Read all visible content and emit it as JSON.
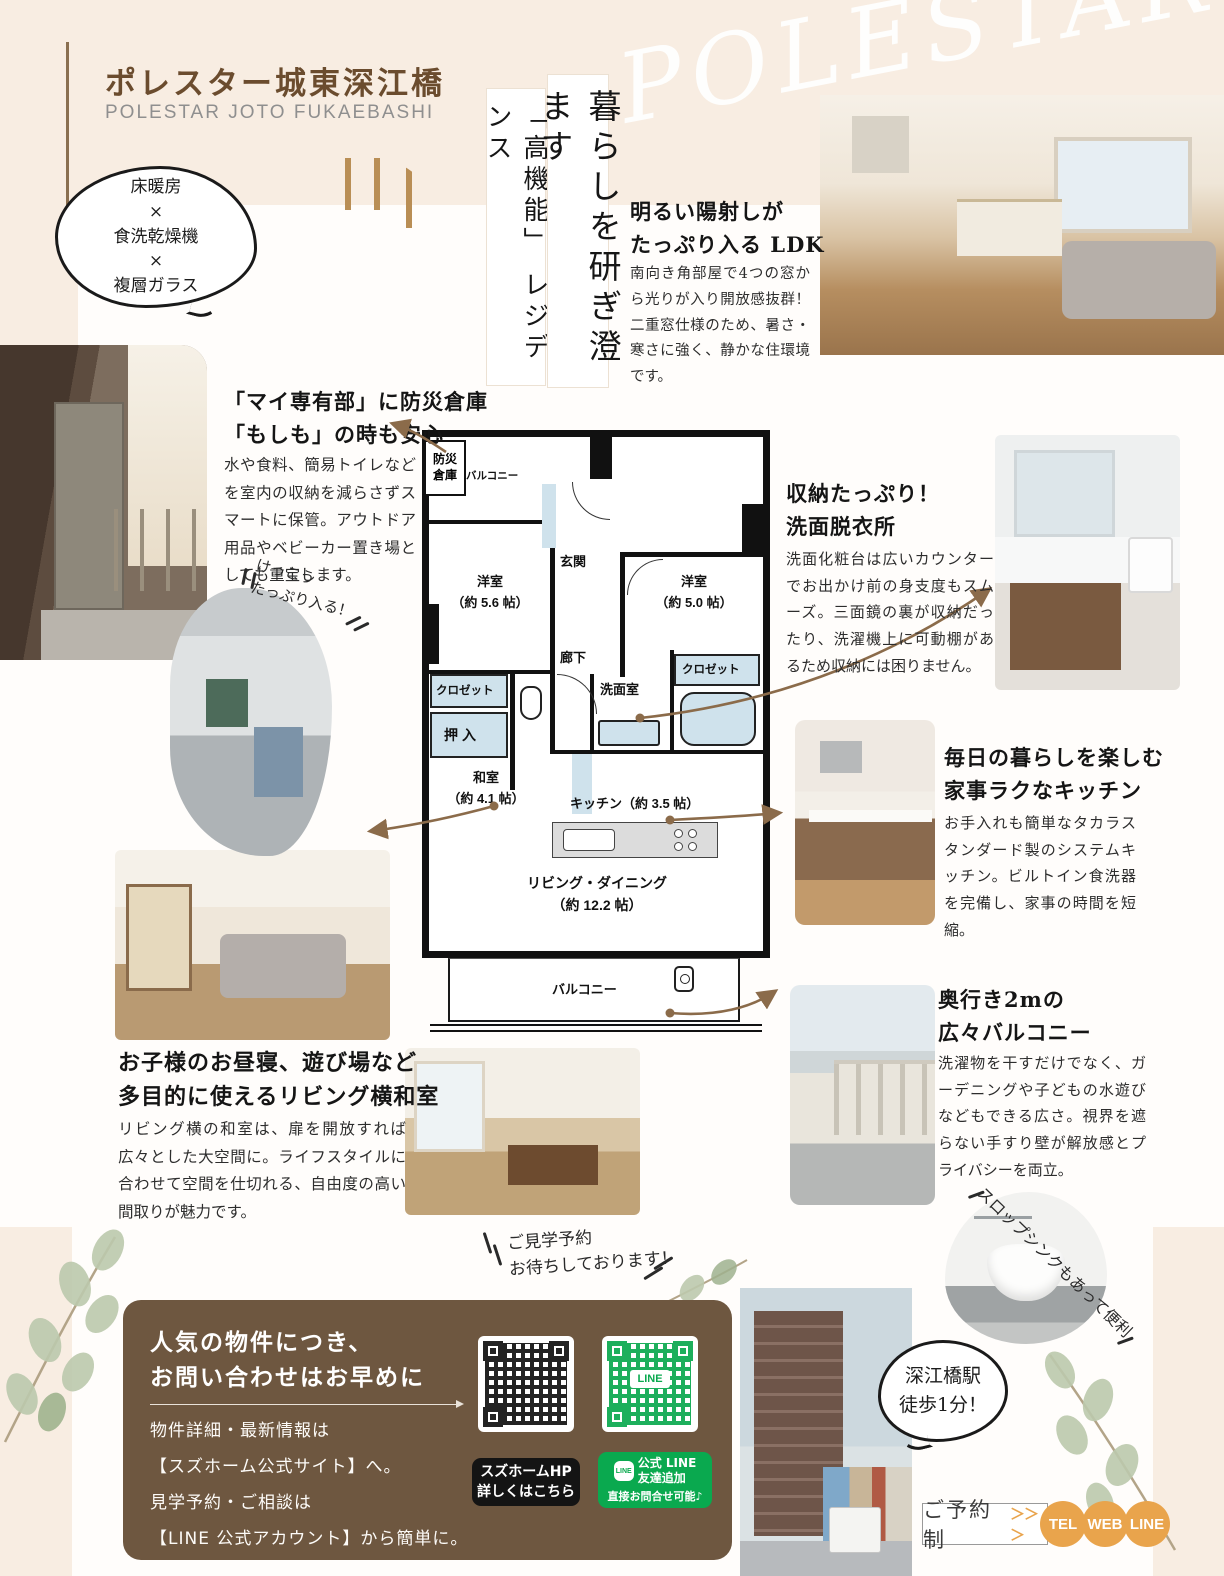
{
  "page": {
    "title": "ポレスター城東深江橋",
    "title_en": "POLESTAR JOTO FUKAEBASHI",
    "watermark": "POLESTAR",
    "features_bubble": "床暖房\n×\n食洗乾燥機\n×\n複層ガラス",
    "tagline_main": "暮らしを研ぎ澄ます",
    "tagline_sub": "「高機能」 レジデンス"
  },
  "sections": {
    "ldk": {
      "heading": "明るい陽射しが\nたっぷり入る LDK",
      "body": "南向き角部屋で4つの窓から光りが入り開放感抜群！二重窓仕様のため、暑さ・寒さに強く、静かな住環境です。"
    },
    "bousai": {
      "heading": "「マイ専有部」に防災倉庫\n「もしも」の時も安心",
      "body": "水や食料、簡易トイレなどを室内の収納を減らさずスマートに保管。アウトドア用品やベビーカー置き場としても重宝します。",
      "note": "けっこう\nたっぷり入る！"
    },
    "senmen": {
      "heading": "収納たっぷり！\n洗面脱衣所",
      "body": "洗面化粧台は広いカウンターでお出かけ前の身支度もスムーズ。三面鏡の裏が収納だったり、洗濯機上に可動棚があるため収納には困りません。"
    },
    "kitchen": {
      "heading": "毎日の暮らしを楽しむ\n家事ラクなキッチン",
      "body": "お手入れも簡単なタカラスタンダード製のシステムキッチン。ビルトイン食洗器を完備し、家事の時間を短縮。"
    },
    "washitsu": {
      "heading": "お子様のお昼寝、遊び場など\n多目的に使えるリビング横和室",
      "body": "リビング横の和室は、扉を開放すれば広々とした大空間に。ライフスタイルに合わせて空間を仕切れる、自由度の高い間取りが魅力です。"
    },
    "balcony": {
      "heading": "奥行き2mの\n広々バルコニー",
      "body": "洗濯物を干すだけでなく、ガーデニングや子どもの水遊びなどもできる広さ。視界を遮らない手すり壁が解放感とプライバシーを両立。",
      "note": "スロップシンクもあって便利"
    }
  },
  "floorplan": {
    "storage": "防災\n倉庫",
    "balcony_top": "バルコニー",
    "entrance": "玄関",
    "bedroom1": "洋室\n（約 5.6 帖）",
    "bedroom2": "洋室\n（約 5.0 帖）",
    "hallway": "廊下",
    "closet1": "クロゼット",
    "closet2": "クロゼット",
    "oshiire": "押入",
    "tatami": "和室\n（約 4.1 帖）",
    "washroom": "洗面室",
    "kitchen": "キッチン（約 3.5 帖）",
    "living": "リビング・ダイニング\n（約 12.2 帖）",
    "balcony_bottom": "バルコニー"
  },
  "visit_note": "ご見学予約\nお待ちしております！",
  "contact": {
    "heading": "人気の物件につき、\nお問い合わせはお早めに",
    "line1": "物件詳細・最新情報は",
    "line2": "【スズホーム公式サイト】へ。",
    "line3": "見学予約・ご相談は",
    "line4": "【LINE 公式アカウント】から簡単に。",
    "qr_hp_label": "スズホームHP\n詳しくはこちら",
    "line_badge": "LINE",
    "qr_line_label": "公式 LINE\n友達追加",
    "qr_line_sub": "直接お問合せ可能♪"
  },
  "footer": {
    "station_bubble": "深江橋駅\n徒歩1分！",
    "reserve": "ご予約制",
    "chevrons": "＞＞＞",
    "buttons": [
      "TEL",
      "WEB",
      "LINE"
    ]
  },
  "colors": {
    "beige": "#f8ede2",
    "title_brown": "#6b4c2e",
    "accent_brown": "#8b6b4a",
    "box_brown": "#6e5740",
    "orange": "#e9a44c",
    "line_green": "#0aa94f",
    "plan_blue": "#cfe2ec"
  }
}
